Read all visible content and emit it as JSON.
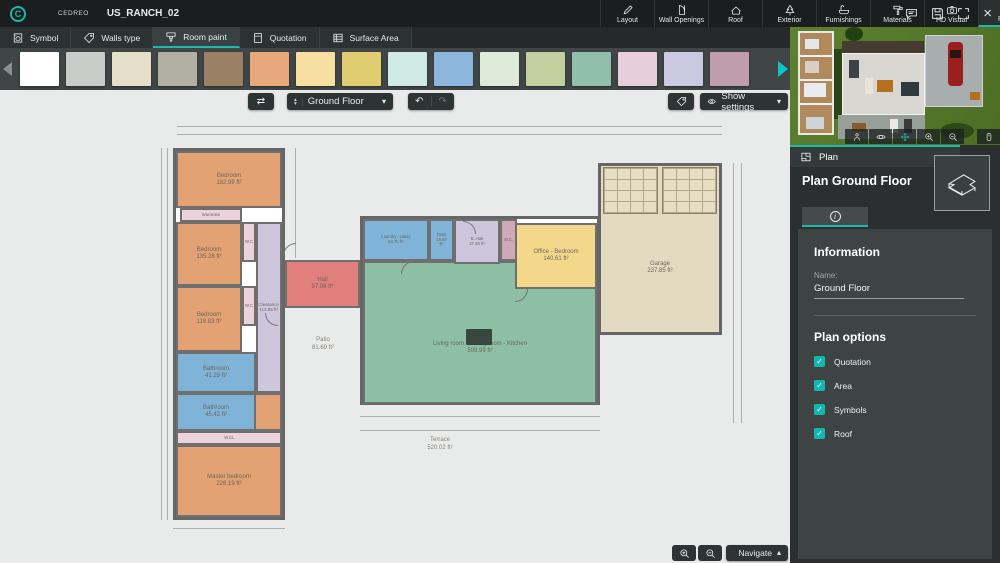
{
  "app": {
    "brand": "CEDREO",
    "title": "US_RANCH_02",
    "accent_color": "#1cb9b1"
  },
  "top_menu": {
    "items": [
      {
        "label": "Layout",
        "icon": "pencil-icon",
        "active": false
      },
      {
        "label": "Wall Openings",
        "icon": "door-icon",
        "active": false
      },
      {
        "label": "Roof",
        "icon": "roof-icon",
        "active": false
      },
      {
        "label": "Exterior",
        "icon": "tree-icon",
        "active": false
      },
      {
        "label": "Furnishings",
        "icon": "bathtub-icon",
        "active": false
      },
      {
        "label": "Materials",
        "icon": "paint-roller-icon",
        "active": false
      },
      {
        "label": "HD Visual",
        "icon": "camera-icon",
        "active": false
      },
      {
        "label": "Plan",
        "icon": "plan-icon",
        "active": true
      }
    ]
  },
  "tools_toolbar": {
    "items": [
      {
        "label": "Symbol",
        "active": false
      },
      {
        "label": "Walls type",
        "active": false
      },
      {
        "label": "Room paint",
        "active": true
      },
      {
        "label": "Quotation",
        "active": false
      },
      {
        "label": "Surface Area",
        "active": false
      }
    ]
  },
  "palette": {
    "colors": [
      "#ffffff",
      "#c9cdc9",
      "#e5dfca",
      "#b2b0a2",
      "#9a8165",
      "#e7a97b",
      "#f7dfa2",
      "#e0cd72",
      "#cfe9e3",
      "#8cb6dc",
      "#dcead7",
      "#c3cf9f",
      "#90bfab",
      "#e8ced8",
      "#cbc8e2",
      "#bf9dab"
    ]
  },
  "canvas": {
    "floor_selector_value": "Ground Floor",
    "show_settings_label": "Show settings",
    "navigate_label": "Navigate"
  },
  "floor_plan": {
    "rooms": {
      "bedroom_top": {
        "name": "Bedroom",
        "area": "182.99 ft²",
        "color": "#e2a273"
      },
      "wardrobe": {
        "name": "Wardrobe",
        "area": "11.21 ft²",
        "color": "#ecd2da"
      },
      "bedroom_mid": {
        "name": "Bedroom",
        "area": "135.28 ft²",
        "color": "#e2a273"
      },
      "wc_1": {
        "name": "W.C.",
        "area": "11.24 ft²",
        "color": "#ecd2da"
      },
      "bedroom_low": {
        "name": "Bedroom",
        "area": "118.83 ft²",
        "color": "#e2a273"
      },
      "wc_2": {
        "name": "W.C.",
        "area": "10.71 ft²",
        "color": "#ecd2da"
      },
      "clearance": {
        "name": "Clearance",
        "area": "112.85 ft²",
        "color": "#cdc6dc"
      },
      "bathroom_1": {
        "name": "Bathroom",
        "area": "41.28 ft²",
        "color": "#7fb3d7"
      },
      "bathroom_2": {
        "name": "Bathroom",
        "area": "45.42 ft²",
        "color": "#7fb3d7"
      },
      "closet": {
        "name": "W.CL",
        "area": "23.41 ft²",
        "color": "#ecd2da"
      },
      "master_bedroom": {
        "name": "Master bedroom",
        "area": "226.19 ft²",
        "color": "#e2a273"
      },
      "hall": {
        "name": "Hall",
        "area": "97.08 ft²",
        "color": "#e07f7c"
      },
      "laundry": {
        "name": "Laundry - Utility",
        "area": "53.75 ft²",
        "color": "#7fb3d7"
      },
      "toilet": {
        "name": "Toilet",
        "area": "18.87 ft²",
        "color": "#7fb3d7"
      },
      "b_hall": {
        "name": "B. Hall",
        "area": "37.26 ft²",
        "color": "#cdc6dc"
      },
      "wc_3": {
        "name": "W.C.",
        "area": "10.71 ft²",
        "color": "#d0a8b8"
      },
      "office": {
        "name": "Office - Bedroom",
        "area": "140.61 ft²",
        "color": "#f3d88b"
      },
      "living": {
        "name": "Living room - Dining room - Kitchen",
        "area": "509.99 ft²",
        "color": "#8cbfa3"
      },
      "garage": {
        "name": "Garage",
        "area": "237.85 ft²",
        "color": "#e2dbc1"
      },
      "patio": {
        "name": "Patio",
        "area": "81.69 ft²"
      },
      "terrace": {
        "name": "Terrace",
        "area": "520.02 ft²"
      }
    }
  },
  "sidebar": {
    "tab_label": "Plan",
    "panel_title": "Plan Ground Floor",
    "information": {
      "heading": "Information",
      "name_label": "Name:",
      "name_value": "Ground Floor"
    },
    "plan_options": {
      "heading": "Plan options",
      "options": [
        {
          "label": "Quotation",
          "checked": true
        },
        {
          "label": "Area",
          "checked": true
        },
        {
          "label": "Symbols",
          "checked": true
        },
        {
          "label": "Roof",
          "checked": true
        }
      ]
    }
  }
}
